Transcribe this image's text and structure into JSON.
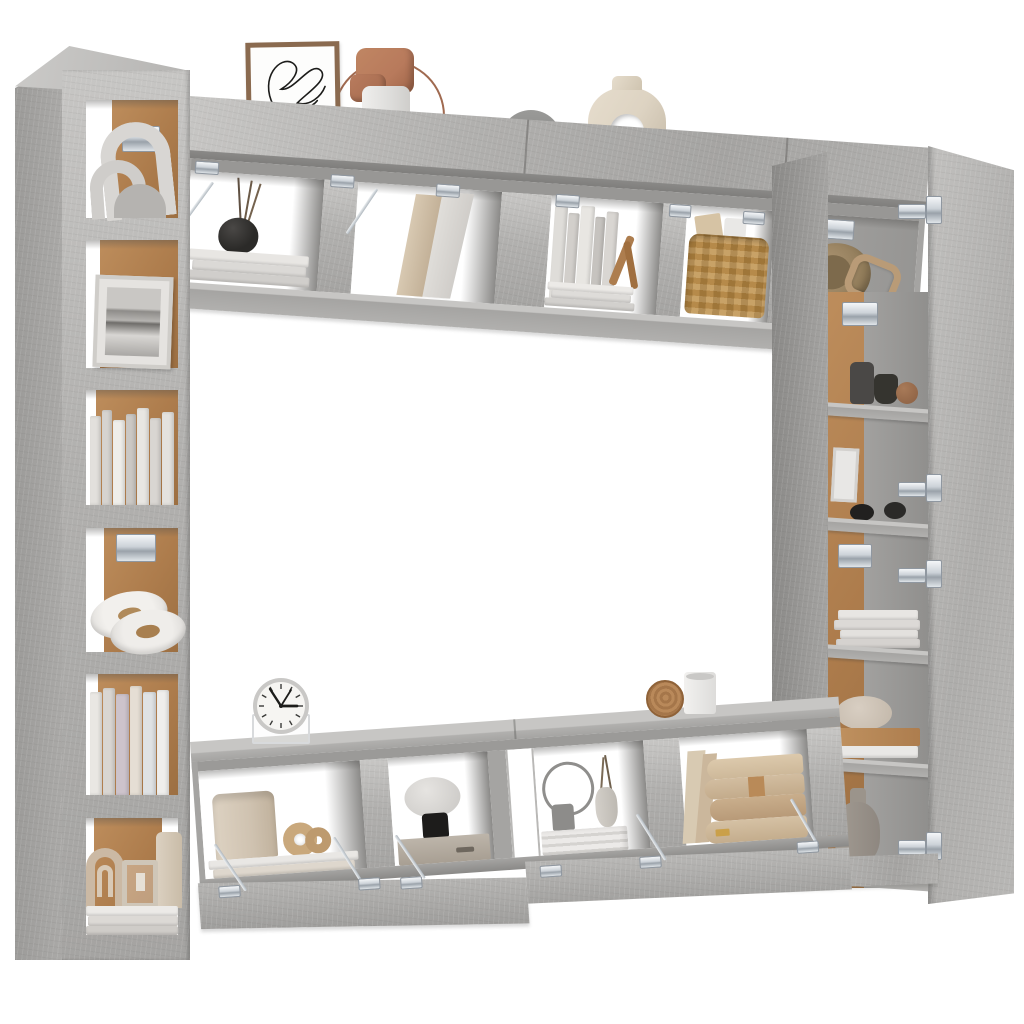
{
  "scene": {
    "type": "product-photo",
    "subject": "8-piece wall-mounted TV entertainment wall unit, concrete gray, shown open with decor, on plain white background",
    "view": "front 3D render with slight perspective tilt"
  },
  "colors": {
    "bg": "#ffffff",
    "concrete": "#b1b0ae",
    "concrete_light": "#c7c6c4",
    "concrete_mid": "#a5a4a2",
    "concrete_dark": "#949391",
    "concrete_deep": "#8a8987",
    "cork": "#ad7c4c",
    "cork_light": "#bd8d5c",
    "black_item": "#2b2a28",
    "white_item": "#eceae7",
    "cream": "#ddd3c2",
    "beige": "#cfc0ac",
    "tan_book": "#c8ad8e",
    "terracotta": "#b87a5c",
    "basket": "#c59c5e",
    "basket_dark": "#b1833f",
    "wood": "#ad7d4e",
    "lavender": "#cdc3cb",
    "clock_face": "#f6f5f2"
  },
  "furniture": {
    "left_tall_cabinet": {
      "label": "Left tall wall cabinet, 6 open compartments with cork backs",
      "compartments": [
        {
          "items": [
            "two white arch sculptures",
            "chrome wall bracket"
          ]
        },
        {
          "items": [
            "framed black-and-white abstract photo"
          ]
        },
        {
          "items": [
            "row of white and cream books"
          ]
        },
        {
          "items": [
            "two oval trinket dishes",
            "chrome wall bracket"
          ]
        },
        {
          "items": [
            "row of pastel books"
          ]
        },
        {
          "items": [
            "beige arch sculpture",
            "lantern candle holder",
            "pillar candle",
            "stacked white trays"
          ]
        }
      ]
    },
    "top_wall_cabinets": {
      "label": "Top wall cabinets with flip-up doors held open by chrome lid stays",
      "compartments": [
        {
          "items": [
            "black reed-diffuser vase",
            "stack of white books"
          ]
        },
        {
          "items": [
            "leaning boards"
          ]
        },
        {
          "items": [
            "standing books",
            "wooden bird figurine",
            "stack of white books"
          ]
        },
        {
          "items": [
            "wicker basket with books and vase"
          ]
        },
        {
          "items": [
            "round hat",
            "tan belt"
          ]
        }
      ],
      "top_decor": [
        "framed line-art print",
        "terracotta sculpture with wire arc",
        "white cylinder vase",
        "gray half-disc vase",
        "cream donut vase"
      ]
    },
    "right_tall_cabinet": {
      "label": "Right tall cabinet with door swung open, 5 shelves",
      "door": {
        "hinge_count": 4,
        "finish": "concrete gray"
      },
      "compartments": [
        {
          "items": [
            "two dark mini vases",
            "clay ball",
            "chrome bracket"
          ]
        },
        {
          "items": [
            "small white frame",
            "two black pebbles"
          ]
        },
        {
          "items": [
            "stack of white books"
          ]
        },
        {
          "items": [
            "stone pebble",
            "wooden board",
            "white tray"
          ]
        },
        {
          "items": [
            "gray teardrop vase"
          ]
        }
      ]
    },
    "bottom_tv_benches": {
      "label": "TV benches with flip-down doors held open by chrome stays",
      "compartments": [
        {
          "items": [
            "beige cylinder vessel",
            "wooden knot sculpture",
            "stack of books"
          ]
        },
        {
          "items": [
            "marble mushroom lamp",
            "wooden crate"
          ]
        },
        {
          "items": [
            "metal ring",
            "small gray jar",
            "bud vase with twigs",
            "white striped box"
          ]
        },
        {
          "items": [
            "stack of large tan books",
            "leaning boards"
          ]
        }
      ],
      "top_decor": [
        "round desk clock on acrylic base",
        "wooden disc",
        "white cup"
      ]
    }
  },
  "clock": {
    "time_shown": "10:08",
    "tick_count": 12
  },
  "hardware": {
    "finish": "chrome",
    "types": [
      "flap hinges",
      "lid stays",
      "wall brackets"
    ]
  }
}
